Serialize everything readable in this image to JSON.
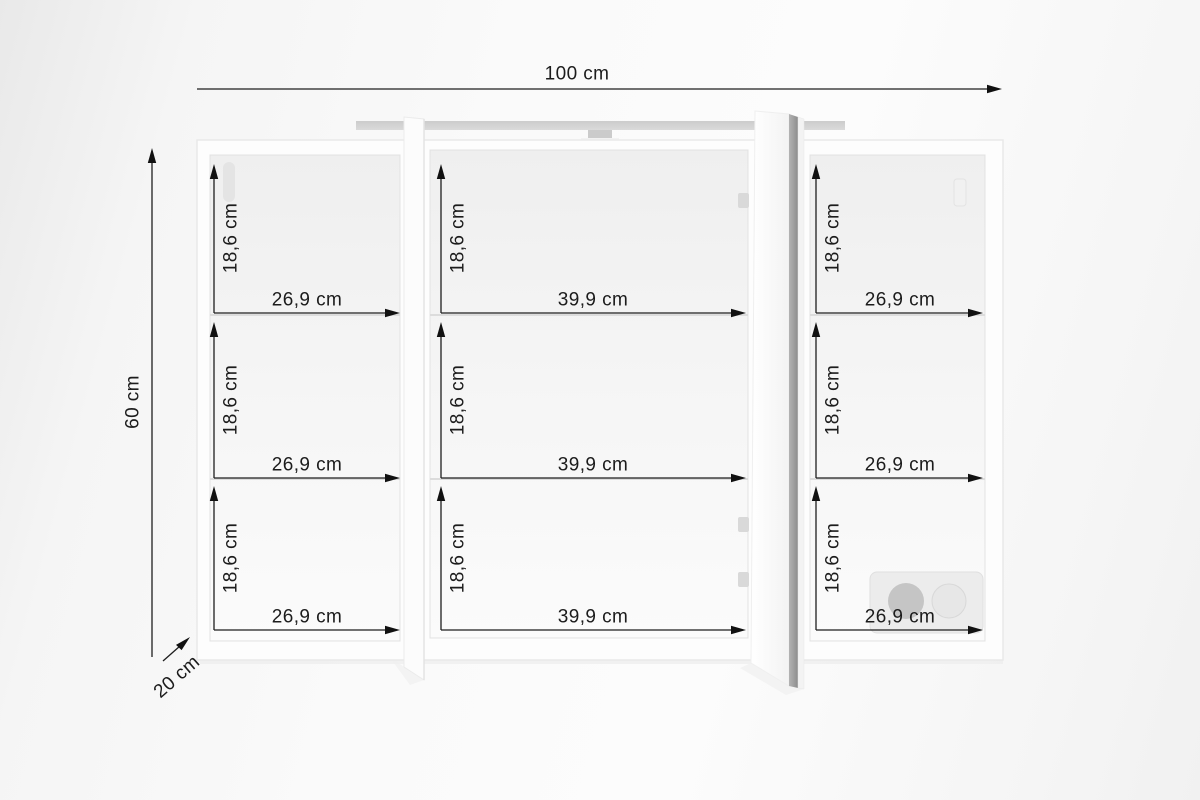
{
  "dimensions": {
    "overall_width": "100 cm",
    "overall_height": "60 cm",
    "depth": "20 cm"
  },
  "cabinet": {
    "sections": [
      {
        "name": "left",
        "compartments": [
          {
            "height_label": "18,6 cm",
            "width_label": "26,9 cm"
          },
          {
            "height_label": "18,6 cm",
            "width_label": "26,9 cm"
          },
          {
            "height_label": "18,6 cm",
            "width_label": "26,9 cm"
          }
        ]
      },
      {
        "name": "middle",
        "compartments": [
          {
            "height_label": "18,6 cm",
            "width_label": "39,9 cm"
          },
          {
            "height_label": "18,6 cm",
            "width_label": "39,9 cm"
          },
          {
            "height_label": "18,6 cm",
            "width_label": "39,9 cm"
          }
        ]
      },
      {
        "name": "right",
        "compartments": [
          {
            "height_label": "18,6 cm",
            "width_label": "26,9 cm"
          },
          {
            "height_label": "18,6 cm",
            "width_label": "26,9 cm"
          },
          {
            "height_label": "18,6 cm",
            "width_label": "26,9 cm"
          }
        ]
      }
    ],
    "features": [
      {
        "name": "led-light-bar"
      },
      {
        "name": "open-mirror-door"
      },
      {
        "name": "double-power-socket"
      }
    ]
  },
  "colors": {
    "dimension_ink": "#1e1e1e",
    "cabinet_white": "#fdfdfd",
    "interior_gray": "#f0f0f0",
    "light_bar_gray": "#d2d2d2",
    "mirror_edge_gray": "#989898",
    "socket_circle_gray": "#c5c5c5",
    "background": "#f7f7f7"
  }
}
